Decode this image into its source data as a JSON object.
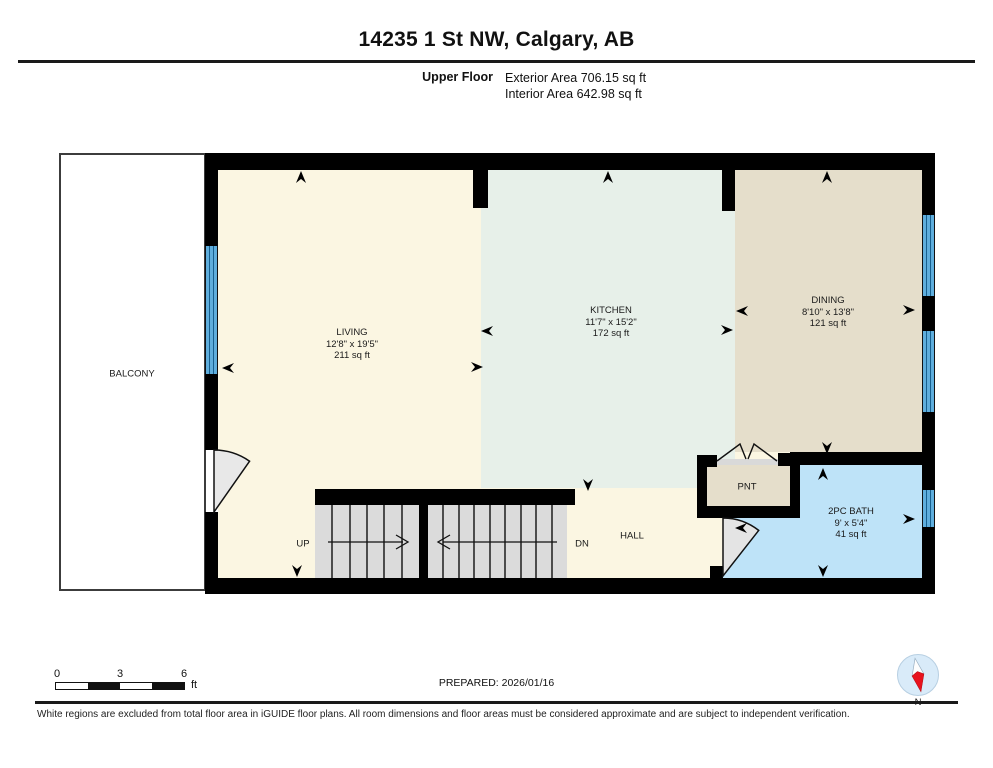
{
  "header": {
    "title": "14235 1 St NW, Calgary, AB",
    "floor_label": "Upper Floor",
    "exterior_area": "Exterior Area 706.15 sq ft",
    "interior_area": "Interior Area 642.98 sq ft"
  },
  "rooms": {
    "balcony": {
      "name": "BALCONY"
    },
    "living": {
      "name": "LIVING",
      "dimensions": "12'8\" x 19'5\"",
      "area": "211 sq ft"
    },
    "kitchen": {
      "name": "KITCHEN",
      "dimensions": "11'7\" x 15'2\"",
      "area": "172 sq ft"
    },
    "dining": {
      "name": "DINING",
      "dimensions": "8'10\" x 13'8\"",
      "area": "121 sq ft"
    },
    "bath": {
      "name": "2PC BATH",
      "dimensions": "9' x 5'4\"",
      "area": "41 sq ft"
    },
    "pantry": {
      "name": "PNT"
    },
    "hall": {
      "name": "HALL"
    }
  },
  "stairs": {
    "up": "UP",
    "down": "DN"
  },
  "scale_bar": {
    "tick_0": "0",
    "tick_3": "3",
    "tick_6": "6",
    "unit": "ft"
  },
  "prepared": "PREPARED: 2026/01/16",
  "compass": {
    "label": "N"
  },
  "footer": "White regions are excluded from total floor area in iGUIDE floor plans. All room dimensions and floor areas must be considered approximate and are subject to independent verification.",
  "colors": {
    "wall": "#000000",
    "living_fill": "#FBF6E2",
    "kitchen_fill": "#E7F0E9",
    "dining_fill": "#E5DECB",
    "bath_fill": "#BEE3F8",
    "window_blue": "#5FAEDD",
    "stair_gray": "#DBDBDB",
    "compass_red": "#E8121D",
    "compass_circle": "#D9EBF9"
  }
}
